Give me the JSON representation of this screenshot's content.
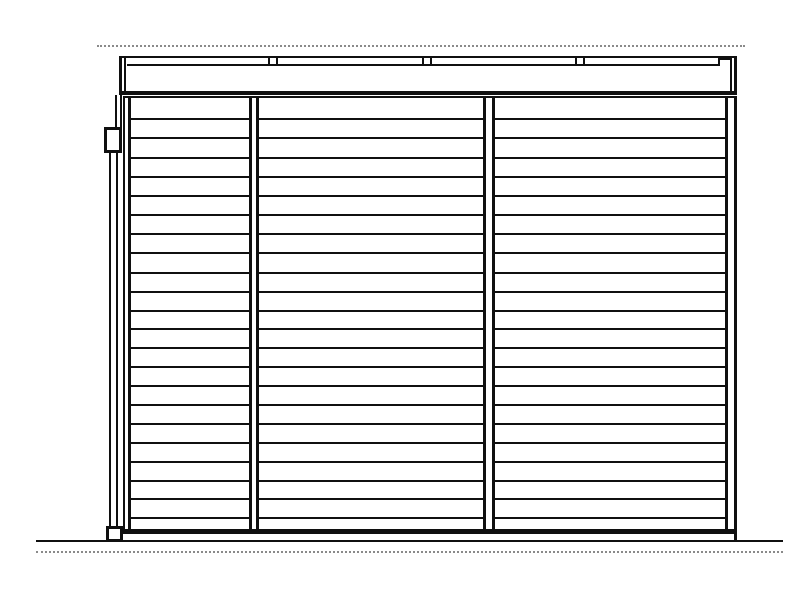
{
  "canvas": {
    "width": 800,
    "height": 600,
    "background_color": "#ffffff",
    "line_color": "#101010",
    "dashed_line_color": "#8a8a8a",
    "drawing_kind": "side-elevation-line-drawing",
    "text_content": "none"
  },
  "drawing": {
    "shapes": [
      {
        "name": "roof-overhang-dashed-line",
        "x": 97,
        "y": 45,
        "w": 648,
        "h": 2,
        "dotted": true
      },
      {
        "name": "fascia-band",
        "x": 119,
        "y": 56,
        "w": 618,
        "h": 39,
        "fill": "white",
        "b": [
          2,
          3,
          4,
          3
        ]
      },
      {
        "name": "fascia-left-inner-line",
        "x": 124,
        "y": 58,
        "w": 2,
        "h": 35,
        "fill": "black"
      },
      {
        "name": "fascia-right-inner-line",
        "x": 730,
        "y": 58,
        "w": 2,
        "h": 35,
        "fill": "black"
      },
      {
        "name": "fascia-cap-line",
        "x": 127,
        "y": 64,
        "w": 592,
        "h": 2,
        "fill": "black"
      },
      {
        "name": "fascia-cap-right-step-vertical",
        "x": 718,
        "y": 58,
        "w": 2,
        "h": 8,
        "fill": "black"
      },
      {
        "name": "fascia-cap-right-step-horizontal",
        "x": 718,
        "y": 58,
        "w": 13,
        "h": 2,
        "fill": "black"
      },
      {
        "name": "cap-joint-tick",
        "x": 268,
        "y": 56,
        "w": 2,
        "h": 10,
        "fill": "black"
      },
      {
        "name": "cap-joint-tick",
        "x": 276,
        "y": 56,
        "w": 2,
        "h": 10,
        "fill": "black"
      },
      {
        "name": "cap-joint-tick",
        "x": 422,
        "y": 56,
        "w": 2,
        "h": 10,
        "fill": "black"
      },
      {
        "name": "cap-joint-tick",
        "x": 430,
        "y": 56,
        "w": 2,
        "h": 10,
        "fill": "black"
      },
      {
        "name": "cap-joint-tick",
        "x": 575,
        "y": 56,
        "w": 2,
        "h": 10,
        "fill": "black"
      },
      {
        "name": "cap-joint-tick",
        "x": 583,
        "y": 56,
        "w": 2,
        "h": 10,
        "fill": "black"
      },
      {
        "name": "wall-top-line",
        "x": 123,
        "y": 96,
        "w": 614,
        "h": 2,
        "fill": "black"
      },
      {
        "name": "wall-slat-line",
        "x": 127,
        "y": 118,
        "w": 604,
        "h": 2,
        "fill": "black"
      },
      {
        "name": "wall-slat-line",
        "x": 127,
        "y": 137,
        "w": 604,
        "h": 2,
        "fill": "black"
      },
      {
        "name": "wall-slat-line",
        "x": 127,
        "y": 157,
        "w": 604,
        "h": 2,
        "fill": "black"
      },
      {
        "name": "wall-slat-line",
        "x": 127,
        "y": 176,
        "w": 604,
        "h": 2,
        "fill": "black"
      },
      {
        "name": "wall-slat-line",
        "x": 127,
        "y": 195,
        "w": 604,
        "h": 2,
        "fill": "black"
      },
      {
        "name": "wall-slat-line",
        "x": 127,
        "y": 214,
        "w": 604,
        "h": 2,
        "fill": "black"
      },
      {
        "name": "wall-slat-line",
        "x": 127,
        "y": 233,
        "w": 604,
        "h": 2,
        "fill": "black"
      },
      {
        "name": "wall-slat-line",
        "x": 127,
        "y": 252,
        "w": 604,
        "h": 2,
        "fill": "black"
      },
      {
        "name": "wall-slat-line",
        "x": 127,
        "y": 272,
        "w": 604,
        "h": 2,
        "fill": "black"
      },
      {
        "name": "wall-slat-line",
        "x": 127,
        "y": 291,
        "w": 604,
        "h": 2,
        "fill": "black"
      },
      {
        "name": "wall-slat-line",
        "x": 127,
        "y": 310,
        "w": 604,
        "h": 2,
        "fill": "black"
      },
      {
        "name": "wall-slat-line",
        "x": 127,
        "y": 328,
        "w": 604,
        "h": 2,
        "fill": "black"
      },
      {
        "name": "wall-slat-line",
        "x": 127,
        "y": 347,
        "w": 604,
        "h": 2,
        "fill": "black"
      },
      {
        "name": "wall-slat-line",
        "x": 127,
        "y": 366,
        "w": 604,
        "h": 2,
        "fill": "black"
      },
      {
        "name": "wall-slat-line",
        "x": 127,
        "y": 385,
        "w": 604,
        "h": 2,
        "fill": "black"
      },
      {
        "name": "wall-slat-line",
        "x": 127,
        "y": 404,
        "w": 604,
        "h": 2,
        "fill": "black"
      },
      {
        "name": "wall-slat-line",
        "x": 127,
        "y": 423,
        "w": 604,
        "h": 2,
        "fill": "black"
      },
      {
        "name": "wall-slat-line",
        "x": 127,
        "y": 442,
        "w": 604,
        "h": 2,
        "fill": "black"
      },
      {
        "name": "wall-slat-line",
        "x": 127,
        "y": 461,
        "w": 604,
        "h": 2,
        "fill": "black"
      },
      {
        "name": "wall-slat-line",
        "x": 127,
        "y": 480,
        "w": 604,
        "h": 2,
        "fill": "black"
      },
      {
        "name": "wall-slat-line",
        "x": 127,
        "y": 498,
        "w": 604,
        "h": 2,
        "fill": "black"
      },
      {
        "name": "wall-slat-line",
        "x": 127,
        "y": 517,
        "w": 604,
        "h": 2,
        "fill": "black"
      },
      {
        "name": "wall-post-left",
        "x": 249,
        "y": 98,
        "w": 10,
        "h": 431,
        "fill": "white",
        "b": [
          0,
          3,
          0,
          3
        ]
      },
      {
        "name": "wall-post-right",
        "x": 483,
        "y": 98,
        "w": 12,
        "h": 431,
        "fill": "white",
        "b": [
          0,
          3,
          0,
          3
        ]
      },
      {
        "name": "wall-left-edge-post",
        "x": 123,
        "y": 98,
        "w": 8,
        "h": 436,
        "fill": "white",
        "b": [
          0,
          3,
          0,
          2
        ]
      },
      {
        "name": "wall-right-edge-post",
        "x": 725,
        "y": 98,
        "w": 12,
        "h": 436,
        "fill": "white",
        "b": [
          0,
          3,
          0,
          3
        ]
      },
      {
        "name": "wall-bottom-rail",
        "x": 123,
        "y": 529,
        "w": 614,
        "h": 5,
        "fill": "black"
      },
      {
        "name": "wall-right-edge-ground-stub",
        "x": 734,
        "y": 534,
        "w": 3,
        "h": 7,
        "fill": "black"
      },
      {
        "name": "downspout-upper-pipe",
        "x": 115,
        "y": 95,
        "w": 7,
        "h": 33,
        "fill": "white",
        "b": [
          0,
          2,
          0,
          2
        ]
      },
      {
        "name": "downspout-collector-box",
        "x": 104,
        "y": 127,
        "w": 18,
        "h": 26,
        "fill": "white",
        "b": [
          3,
          3,
          3,
          3
        ]
      },
      {
        "name": "downspout-pipe",
        "x": 109,
        "y": 153,
        "w": 9,
        "h": 374,
        "fill": "white",
        "b": [
          0,
          2,
          0,
          2
        ]
      },
      {
        "name": "downspout-foot",
        "x": 106,
        "y": 526,
        "w": 17,
        "h": 15,
        "fill": "white",
        "b": [
          3,
          3,
          2,
          3
        ]
      },
      {
        "name": "ground-line",
        "x": 36,
        "y": 540,
        "w": 747,
        "h": 2,
        "fill": "black"
      },
      {
        "name": "ground-dashed-line",
        "x": 36,
        "y": 551,
        "w": 747,
        "h": 2,
        "dotted": true
      }
    ]
  }
}
